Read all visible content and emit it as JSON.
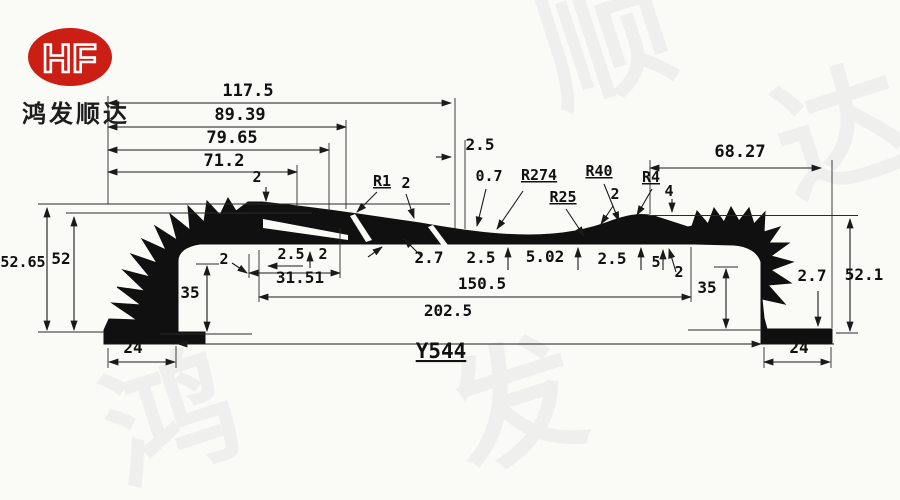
{
  "brand": {
    "logo_text": "HF",
    "company_name": "鸿发顺达",
    "logo_color": "#cb1f15"
  },
  "drawing": {
    "part_number": "Y544",
    "line_color": "#1a1a1a",
    "background_color": "#fafaf7",
    "watermark": {
      "opacity": 0.05,
      "chars": [
        {
          "ch": "顺",
          "x": 620,
          "y": 85,
          "rot": -18
        },
        {
          "ch": "达",
          "x": 855,
          "y": 175,
          "rot": -18
        },
        {
          "ch": "鸿",
          "x": 185,
          "y": 462,
          "rot": -18
        },
        {
          "ch": "发",
          "x": 530,
          "y": 448,
          "rot": -18
        }
      ]
    },
    "labels": [
      {
        "text": "117.5",
        "x": 248,
        "y": 96,
        "size": 17
      },
      {
        "text": "89.39",
        "x": 240,
        "y": 120,
        "size": 17
      },
      {
        "text": "79.65",
        "x": 232,
        "y": 143,
        "size": 17
      },
      {
        "text": "71.2",
        "x": 224,
        "y": 166,
        "size": 17
      },
      {
        "text": "2.5",
        "x": 480,
        "y": 150,
        "size": 16
      },
      {
        "text": "68.27",
        "x": 740,
        "y": 157,
        "size": 17
      },
      {
        "text": "2",
        "x": 257,
        "y": 182,
        "size": 15
      },
      {
        "text": "R1",
        "x": 382,
        "y": 186,
        "size": 15,
        "u": true
      },
      {
        "text": "2",
        "x": 406,
        "y": 188,
        "size": 15
      },
      {
        "text": "0.7",
        "x": 489,
        "y": 181,
        "size": 15
      },
      {
        "text": "R274",
        "x": 539,
        "y": 180,
        "size": 15,
        "u": true
      },
      {
        "text": "R25",
        "x": 563,
        "y": 202,
        "size": 15,
        "u": true
      },
      {
        "text": "R40",
        "x": 599,
        "y": 176,
        "size": 15,
        "u": true
      },
      {
        "text": "2",
        "x": 615,
        "y": 199,
        "size": 15
      },
      {
        "text": "R4",
        "x": 651,
        "y": 182,
        "size": 15,
        "u": true
      },
      {
        "text": "4",
        "x": 669,
        "y": 196,
        "size": 15
      },
      {
        "text": "52.65",
        "x": 23,
        "y": 267,
        "size": 15
      },
      {
        "text": "52",
        "x": 61,
        "y": 264,
        "size": 16
      },
      {
        "text": "35",
        "x": 190,
        "y": 298,
        "size": 16
      },
      {
        "text": "2",
        "x": 224,
        "y": 264,
        "size": 15
      },
      {
        "text": "2.5",
        "x": 291,
        "y": 259,
        "size": 15
      },
      {
        "text": "2",
        "x": 323,
        "y": 259,
        "size": 15
      },
      {
        "text": "31.51",
        "x": 300,
        "y": 283,
        "size": 16
      },
      {
        "text": "2.7",
        "x": 429,
        "y": 263,
        "size": 16
      },
      {
        "text": "2.5",
        "x": 481,
        "y": 263,
        "size": 16
      },
      {
        "text": "5.02",
        "x": 545,
        "y": 262,
        "size": 16
      },
      {
        "text": "2.5",
        "x": 612,
        "y": 264,
        "size": 16
      },
      {
        "text": "5",
        "x": 656,
        "y": 267,
        "size": 15
      },
      {
        "text": "2",
        "x": 679,
        "y": 277,
        "size": 15
      },
      {
        "text": "150.5",
        "x": 482,
        "y": 289,
        "size": 16
      },
      {
        "text": "202.5",
        "x": 448,
        "y": 316,
        "size": 16
      },
      {
        "text": "35",
        "x": 707,
        "y": 293,
        "size": 16
      },
      {
        "text": "2.7",
        "x": 812,
        "y": 281,
        "size": 16
      },
      {
        "text": "52.1",
        "x": 864,
        "y": 280,
        "size": 16
      },
      {
        "text": "24",
        "x": 133,
        "y": 353,
        "size": 16
      },
      {
        "text": "24",
        "x": 799,
        "y": 353,
        "size": 16
      },
      {
        "text": "Y544",
        "x": 441,
        "y": 358,
        "size": 21,
        "u": true,
        "bold": true
      }
    ]
  }
}
